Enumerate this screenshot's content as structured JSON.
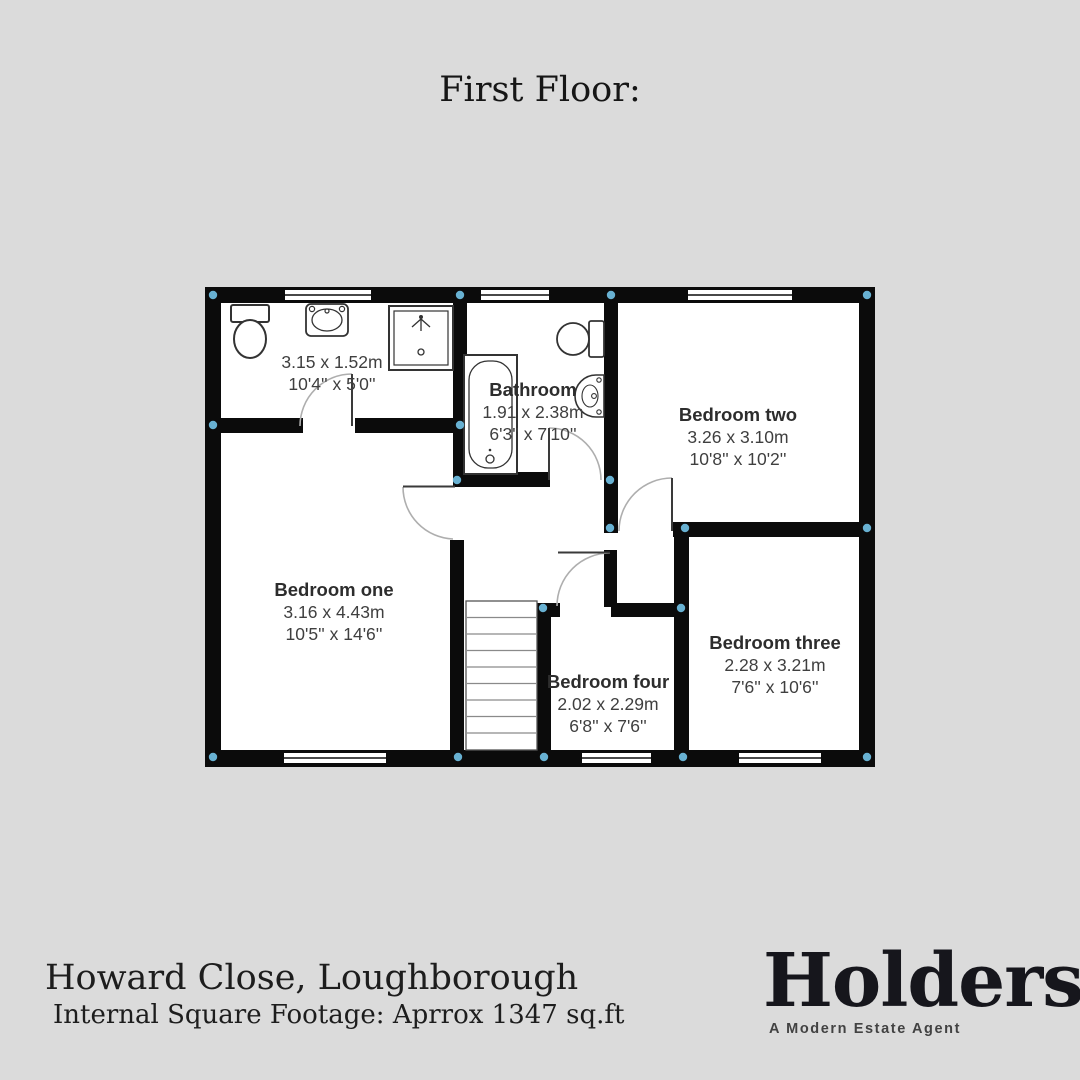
{
  "header": {
    "title": "First Floor:"
  },
  "plan": {
    "rooms": [
      {
        "id": "shower-room",
        "name": "",
        "dims_m": "3.15 x 1.52m",
        "dims_ft": "10'4'' x 5'0''"
      },
      {
        "id": "bathroom",
        "name": "Bathroom",
        "dims_m": "1.91 x 2.38m",
        "dims_ft": "6'3'' x 7'10''"
      },
      {
        "id": "bedroom-two",
        "name": "Bedroom two",
        "dims_m": "3.26 x 3.10m",
        "dims_ft": "10'8'' x 10'2''"
      },
      {
        "id": "bedroom-one",
        "name": "Bedroom one",
        "dims_m": "3.16 x 4.43m",
        "dims_ft": "10'5'' x 14'6''"
      },
      {
        "id": "bedroom-four",
        "name": "Bedroom four",
        "dims_m": "2.02 x 2.29m",
        "dims_ft": "6'8'' x 7'6''"
      },
      {
        "id": "bedroom-three",
        "name": "Bedroom three",
        "dims_m": "2.28 x 3.21m",
        "dims_ft": "7'6'' x 10'6''"
      }
    ],
    "fixtures": [
      "toilet",
      "sink",
      "shower",
      "bathtub",
      "toilet",
      "sink",
      "stairs"
    ],
    "colors": {
      "background": "#dbdbdb",
      "wall": "#0b0b0b",
      "room_fill": "#ffffff",
      "junction_marker": "#68b1d2",
      "door_arc": "#aeaeae"
    }
  },
  "footer": {
    "address": "Howard Close, Loughborough",
    "footage": "Internal Square Footage: Aprrox 1347 sq.ft",
    "brand": {
      "name": "Holders",
      "tagline": "A Modern Estate Agent"
    }
  }
}
